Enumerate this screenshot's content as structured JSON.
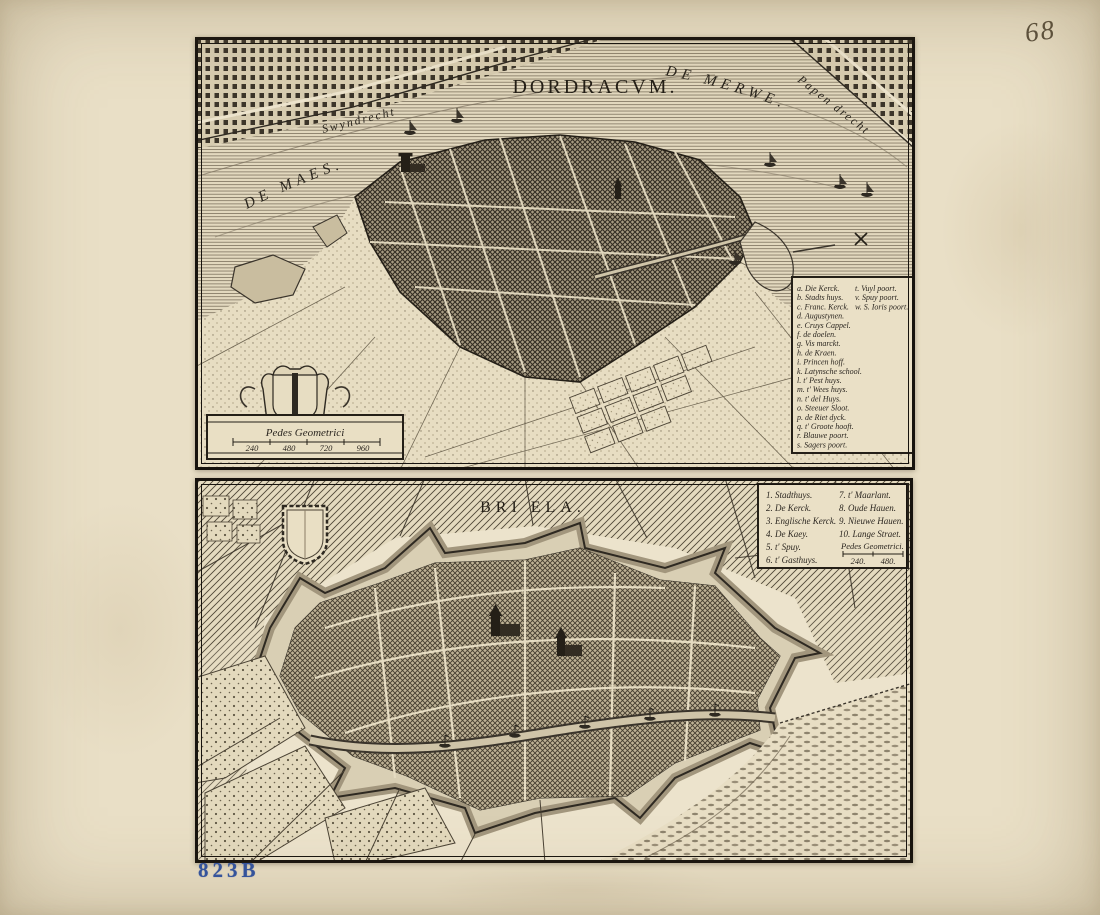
{
  "page": {
    "handwritten_page_number": "68",
    "collection_stamp": "823B"
  },
  "dordracum": {
    "title": "DORDRACVM.",
    "labels": {
      "merwe": "DE MERWE.",
      "maes": "DE MAES.",
      "swyndrecht": "Swyndrecht",
      "papendrecht": "Papen drecht"
    },
    "legend": {
      "rows": [
        {
          "c1": "a. Die Kerck.",
          "c2": "t. Vuyl poort."
        },
        {
          "c1": "b. Stadts huys.",
          "c2": "v. Spuy poort."
        },
        {
          "c1": "c. Franc. Kerck.",
          "c2": "w. S. Ioris poort."
        },
        {
          "c1": "d. Augustynen.",
          "c2": ""
        },
        {
          "c1": "e. Cruys Cappel.",
          "c2": ""
        },
        {
          "c1": "f. de doelen.",
          "c2": ""
        },
        {
          "c1": "g. Vis marckt.",
          "c2": ""
        },
        {
          "c1": "h. de Kraen.",
          "c2": ""
        },
        {
          "c1": "i. Princen hoff.",
          "c2": ""
        },
        {
          "c1": "k. Latynsche school.",
          "c2": ""
        },
        {
          "c1": "l. t' Pest huys.",
          "c2": ""
        },
        {
          "c1": "m. t' Wees huys.",
          "c2": ""
        },
        {
          "c1": "n. t' del Huys.",
          "c2": ""
        },
        {
          "c1": "o. Steeuer Sloot.",
          "c2": ""
        },
        {
          "c1": "p. de Riet dyck.",
          "c2": ""
        },
        {
          "c1": "q. t' Groote hooft.",
          "c2": ""
        },
        {
          "c1": "r. Blauwe poort.",
          "c2": ""
        },
        {
          "c1": "s. Sagers poort.",
          "c2": ""
        }
      ]
    },
    "scale": {
      "label": "Pedes Geometrici",
      "ticks": [
        "240",
        "480",
        "720",
        "960"
      ]
    }
  },
  "briela": {
    "title": "BRI ELA.",
    "legend": {
      "col1": [
        "1. Stadthuys.",
        "2. De Kerck.",
        "3. Englische Kerck.",
        "4. De Kaey.",
        "5. t' Spuy.",
        "6. t' Gasthuys."
      ],
      "col2": [
        "7. t' Maarlant.",
        "8. Oude Hauen.",
        "9. Nieuwe Hauen.",
        "10. Lange Straet."
      ],
      "scale_label": "Pedes Geometrici.",
      "scale_ticks": [
        "240.",
        "480."
      ]
    }
  }
}
